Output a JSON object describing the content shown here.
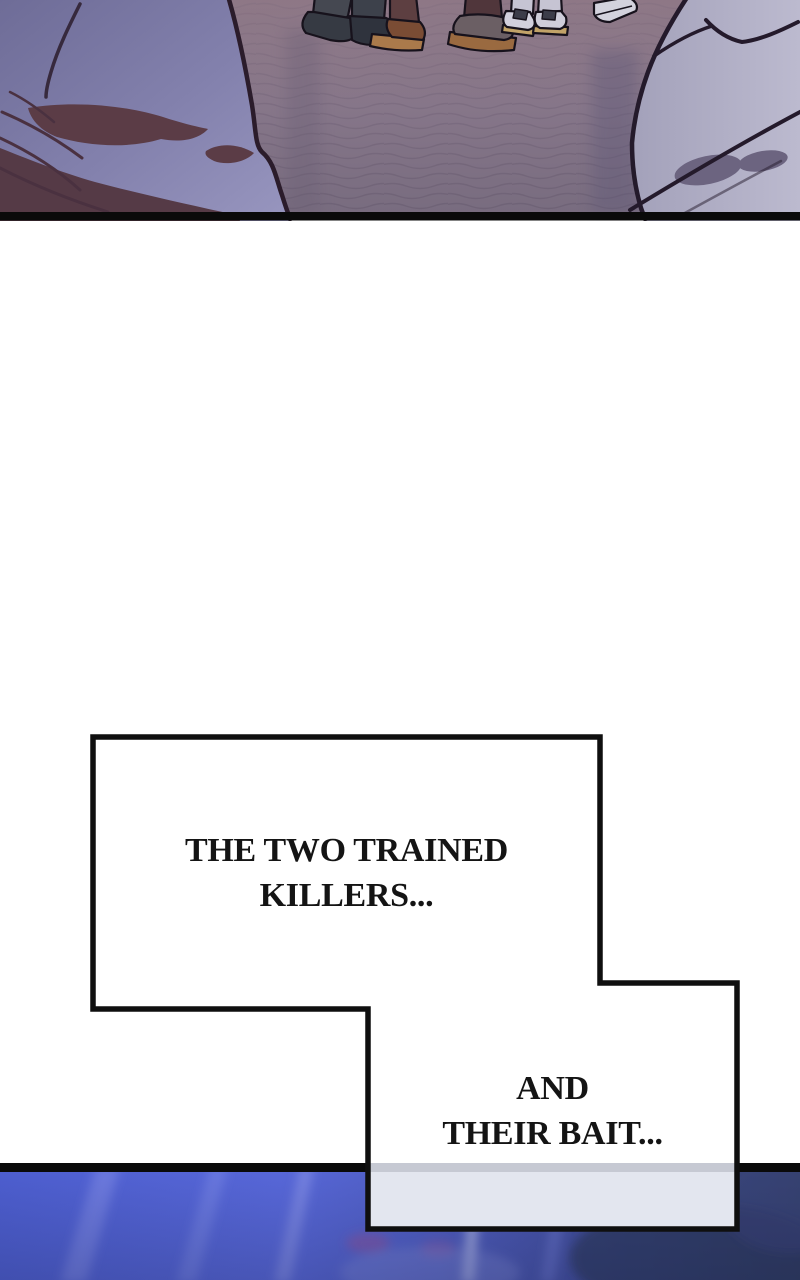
{
  "page": {
    "width_px": 800,
    "height_px": 1280,
    "background": "#ffffff",
    "kind": "webtoon comic strip segment"
  },
  "panel_top": {
    "alt": "street scene seen between two out-of-focus foreground figures; several people's shoes standing on mauve cobblestone pavement",
    "colors": {
      "ground_top": "#8e7e8d",
      "ground_bottom": "#786c7f",
      "cobble_line": "#574a60",
      "figure_left_fill": "#8381ad",
      "figure_right_fill": "#b2b0c7",
      "shadow_maroon": "#5b3c46",
      "outline": "#2b1c2b",
      "panel_border": "#0a0a0a"
    }
  },
  "speech": {
    "box1": {
      "lines": [
        "THE TWO TRAINED",
        "KILLERS..."
      ]
    },
    "box2": {
      "lines": [
        "AND",
        "THEIR BAIT..."
      ]
    },
    "fill_color": "#ffffff",
    "border_color": "#0f0f0f",
    "text_color": "#141414",
    "overlap_tint": "#e3e6ef",
    "overlap_line_tint": "#c6c9d3"
  },
  "panel_bottom": {
    "alt": "blurred deep-blue water with diagonal light streaks, darker toward lower right",
    "colors": {
      "base_left": "#4d5ecf",
      "base_mid": "#5767d8",
      "base_right": "#343d63",
      "streak_light": "#c7cdf0",
      "streak_blue": "#7f8be6",
      "magenta_smudge": "#9a4f92",
      "panel_border": "#0a0a0a"
    }
  }
}
